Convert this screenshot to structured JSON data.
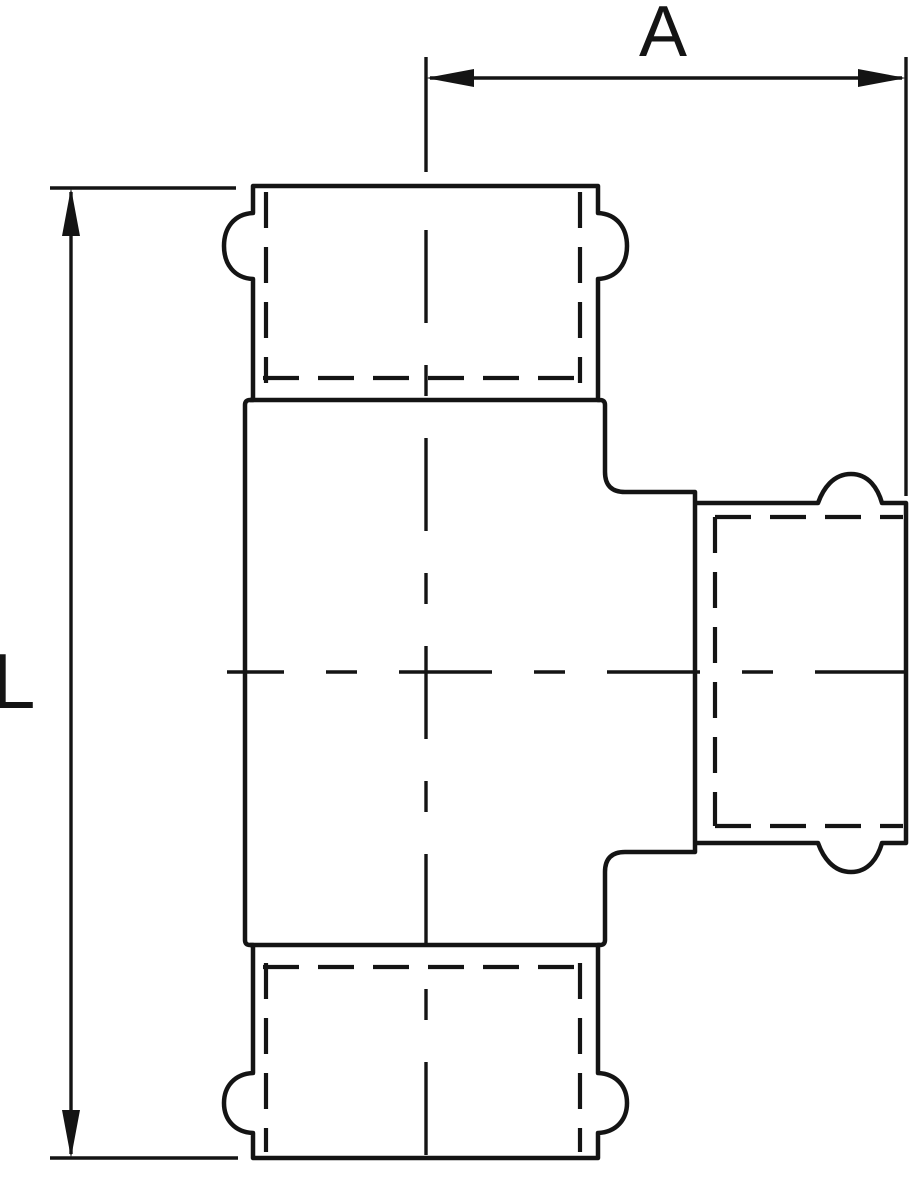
{
  "diagram": {
    "type": "technical drawing",
    "subject": "tee pipe fitting, front view with hidden socket bores",
    "background": "#ffffff",
    "line_color": "#141414",
    "dimensions": {
      "horizontal": {
        "label": "A"
      },
      "vertical": {
        "label": "L"
      }
    }
  }
}
